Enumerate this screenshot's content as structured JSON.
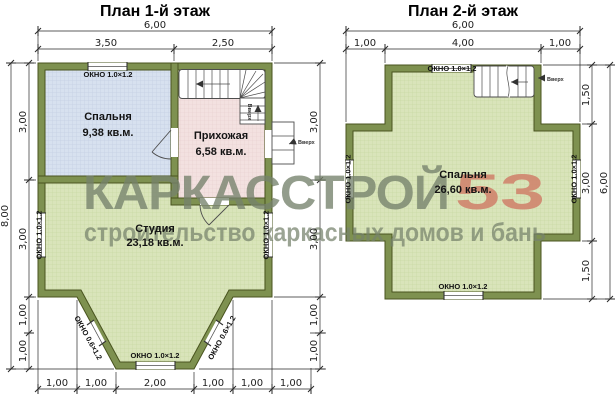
{
  "watermark": {
    "brand": "КАРКАССТРОЙ",
    "number": "53",
    "tagline": "строительство каркасных домов и бань"
  },
  "floor1": {
    "title": "План 1-й этаж",
    "rooms": {
      "bedroom": {
        "name": "Спальня",
        "area": "9,38 кв.м."
      },
      "hall": {
        "name": "Прихожая",
        "area": "6,58 кв.м."
      },
      "studio": {
        "name": "Студия",
        "area": "23,18 кв.м."
      }
    },
    "windows": {
      "top": "ОКНО 1.0×1.2",
      "left": "ОКНО 1.0×1.2",
      "right": "ОКНО 1.0×1.2",
      "bay_left": "ОКНО 0.6×1.2",
      "bay_front": "ОКНО 1.0×1.2",
      "bay_right": "ОКНО 0.6×1.2"
    },
    "labels": {
      "stairs_up": "Вверх",
      "entry_up": "Вверх"
    },
    "dims": {
      "top_total": "6,00",
      "top_left": "3,50",
      "top_right": "2,50",
      "side_total": "8,00",
      "side_1": "3,00",
      "side_2": "3,00",
      "side_3": "1,00",
      "side_4": "1,00",
      "right_1": "3,00",
      "right_2": "3,00",
      "right_3": "1,00",
      "right_4": "1,00",
      "bottom_1": "1,00",
      "bottom_2": "1,00",
      "bottom_3": "2,00",
      "bottom_4": "1,00",
      "bottom_5": "1,00",
      "bottom_6": "1,00"
    }
  },
  "floor2": {
    "title": "План 2-й этаж",
    "rooms": {
      "bedroom": {
        "name": "Спальня",
        "area": "26,60 кв.м."
      }
    },
    "windows": {
      "top": "ОКНО 1.0×1.2",
      "left": "ОКНО 1.0×1.2",
      "right": "ОКНО 1.0×1.2",
      "bottom": "ОКНО 1.0×1.2"
    },
    "labels": {
      "stairs_up": "Вверх"
    },
    "dims": {
      "top_total": "6,00",
      "top_1": "1,00",
      "top_2": "4,00",
      "top_3": "1,00",
      "right_1": "1,50",
      "right_2": "3,00",
      "right_3": "1,50",
      "right_total": "6,00"
    }
  },
  "colors": {
    "wall": "#7e9150",
    "wallStroke": "#49541f",
    "dim": "#2a2a2a",
    "wm": "#76826c",
    "wmAccent": "#d0806a"
  }
}
